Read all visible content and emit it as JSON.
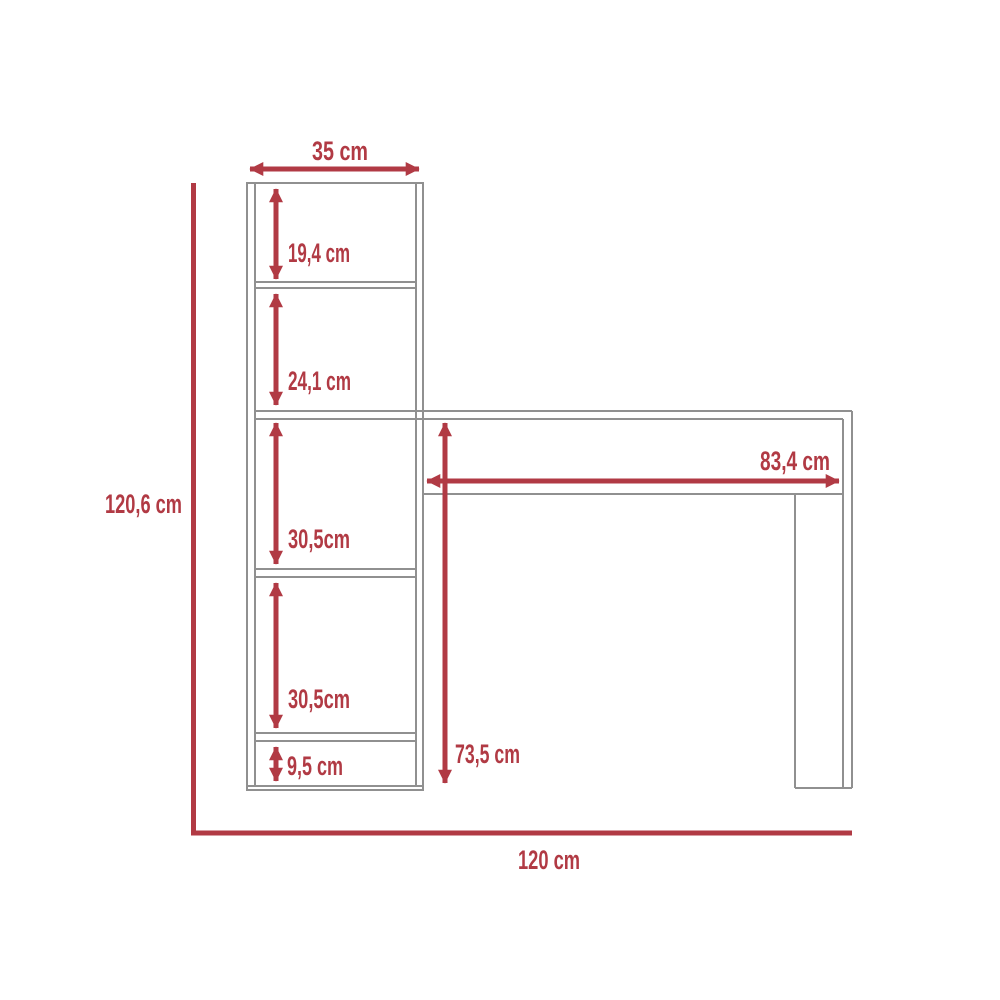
{
  "diagram": {
    "type": "furniture-dimension-diagram",
    "subject": "desk-with-shelf-tower",
    "unit": "cm",
    "colors": {
      "dimension_red": "#b13a44",
      "furniture_outline_gray": "#909090",
      "background": "#ffffff"
    },
    "labels": {
      "tower_width": "35 cm",
      "tower_section_1": "19,4 cm",
      "tower_section_2": "24,1 cm",
      "tower_section_3": "30,5cm",
      "tower_section_4": "30,5cm",
      "tower_section_5": "9,5 cm",
      "total_height": "120,6 cm",
      "desk_clear_width": "83,4 cm",
      "desk_height": "73,5 cm",
      "total_width": "120 cm"
    },
    "values_cm": {
      "tower_width": 35,
      "tower_section_1": 19.4,
      "tower_section_2": 24.1,
      "tower_section_3": 30.5,
      "tower_section_4": 30.5,
      "tower_section_5": 9.5,
      "total_height": 120.6,
      "desk_clear_width": 83.4,
      "desk_height": 73.5,
      "total_width": 120
    }
  }
}
